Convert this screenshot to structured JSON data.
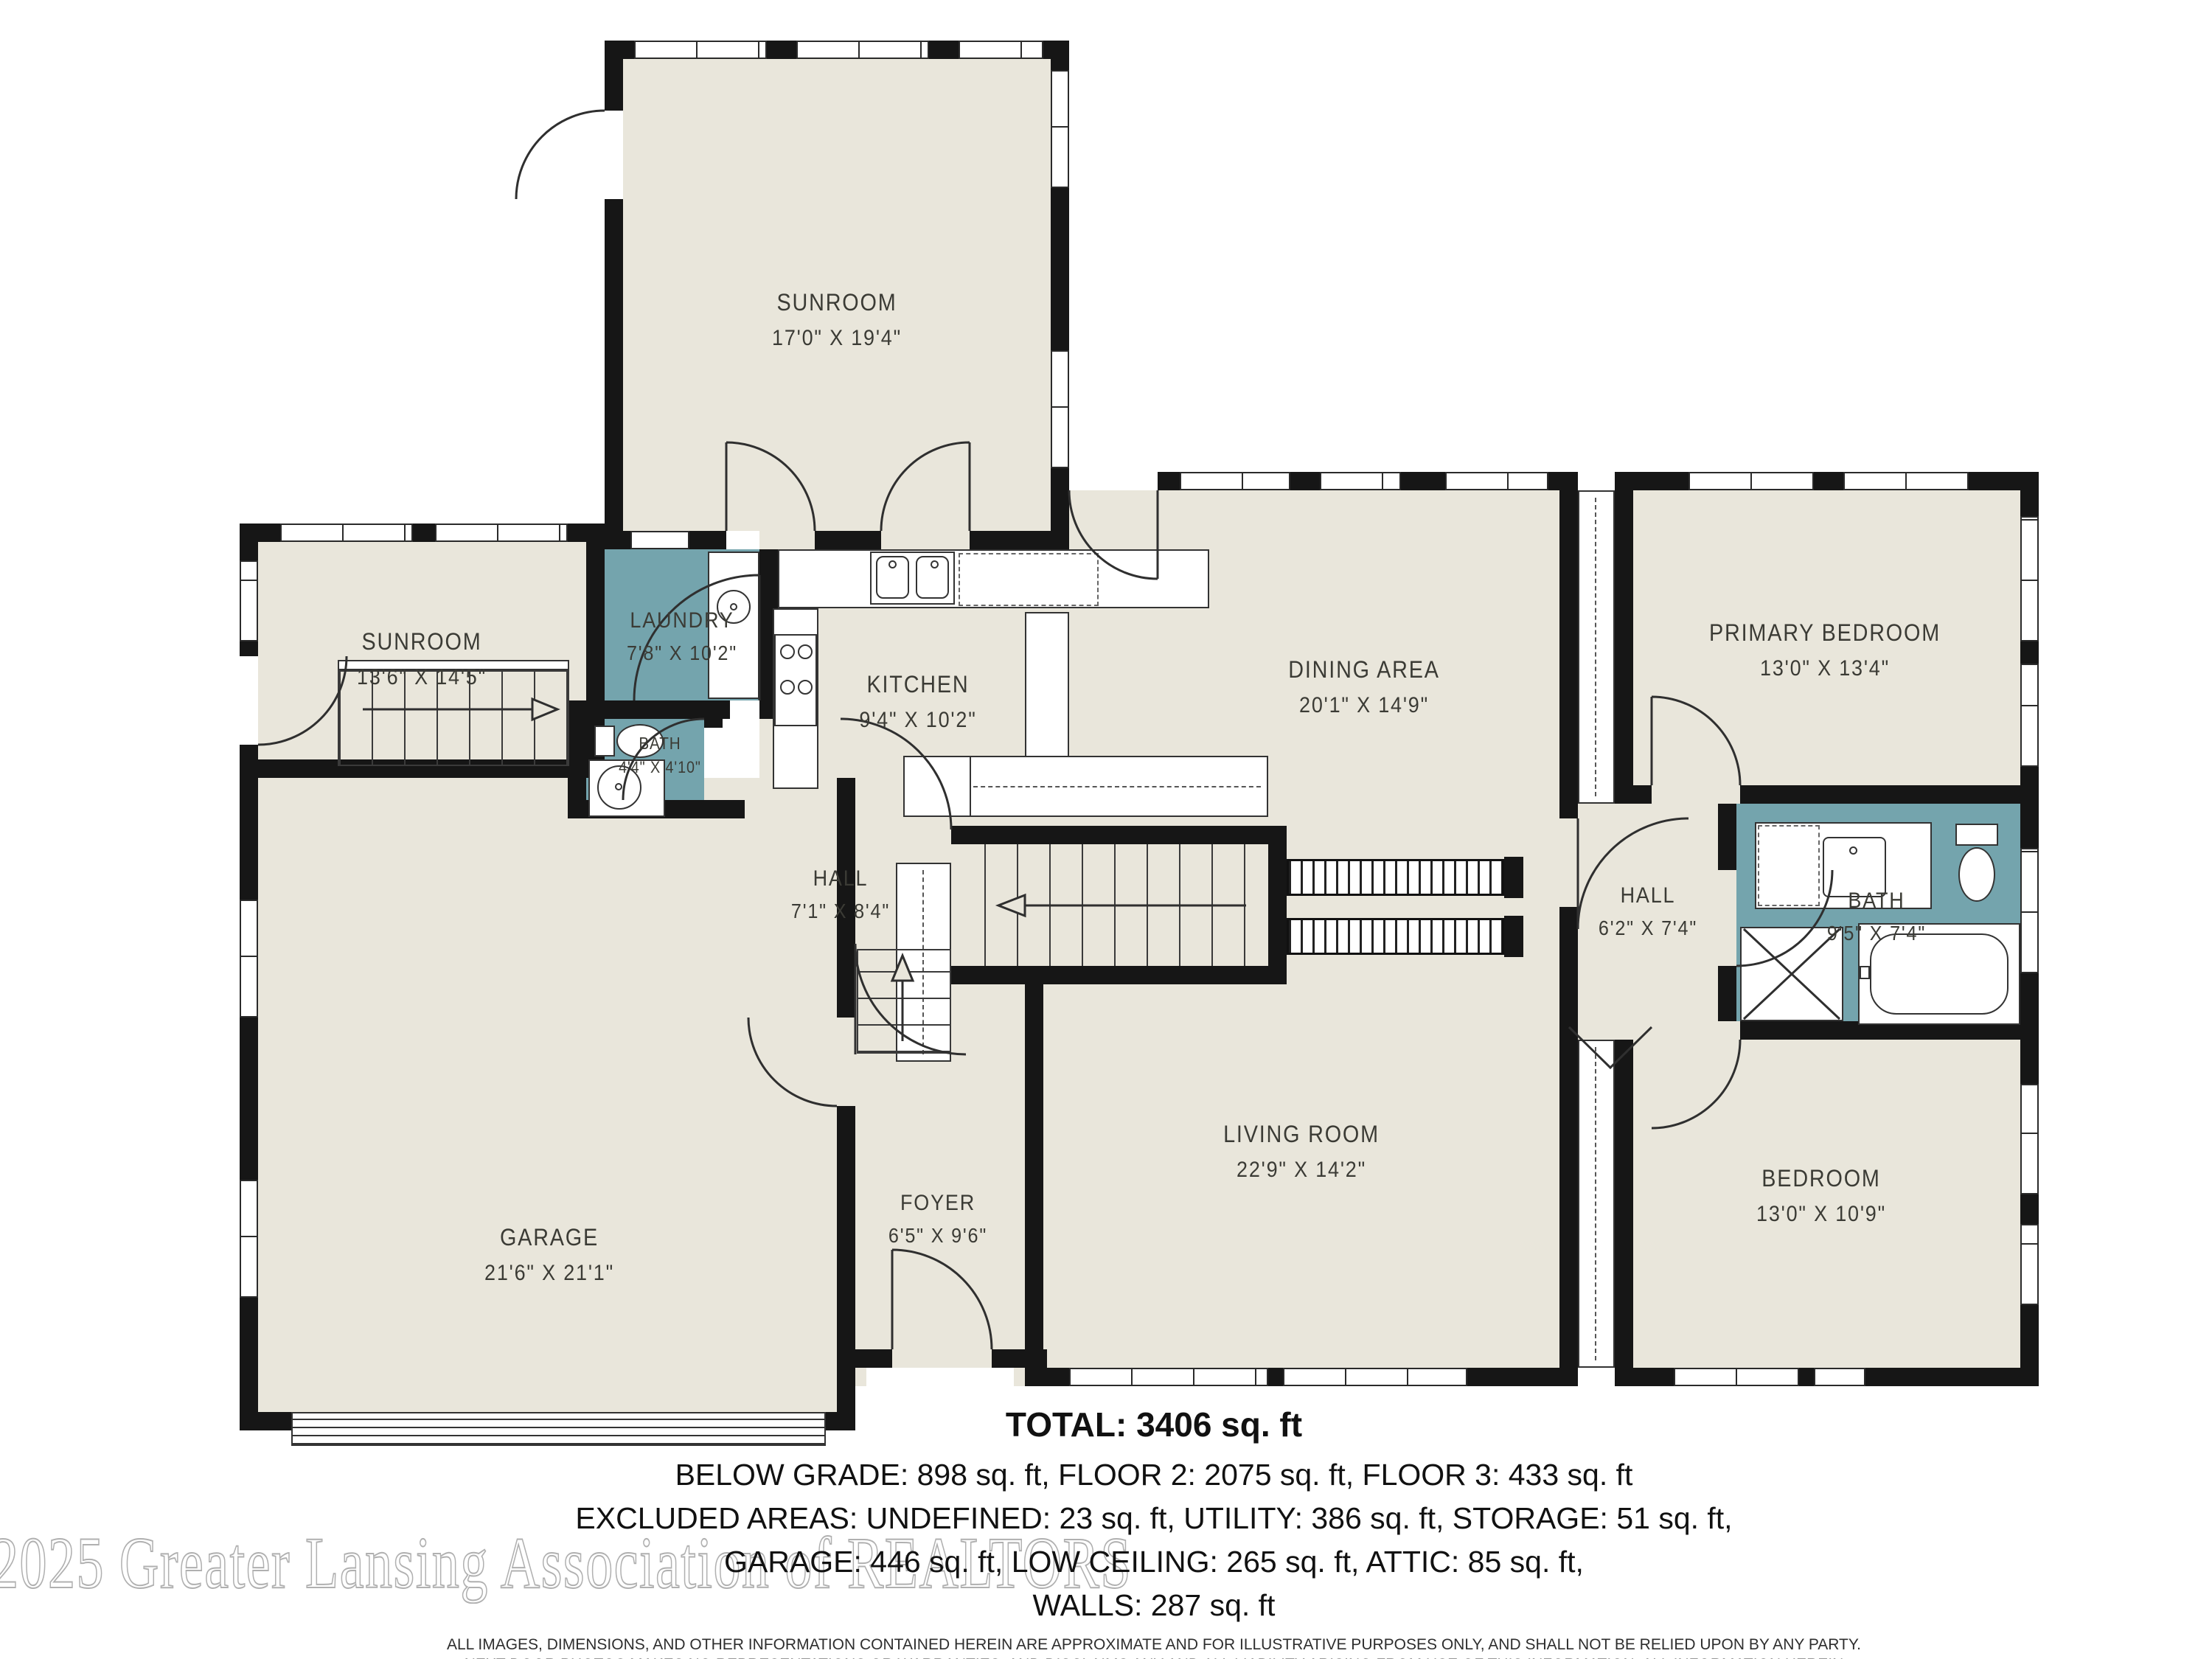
{
  "floorplan": {
    "rooms": [
      {
        "id": "sunroom_top",
        "name": "SUNROOM",
        "dims": "17'0\" X 19'4\""
      },
      {
        "id": "sunroom_left",
        "name": "SUNROOM",
        "dims": "13'6\" X 14'5\""
      },
      {
        "id": "laundry",
        "name": "LAUNDRY",
        "dims": "7'8\" X 10'2\""
      },
      {
        "id": "bath_small",
        "name": "BATH",
        "dims": "4'4\" X 4'10\""
      },
      {
        "id": "kitchen",
        "name": "KITCHEN",
        "dims": "9'4\" X 10'2\""
      },
      {
        "id": "dining_area",
        "name": "DINING AREA",
        "dims": "20'1\" X 14'9\""
      },
      {
        "id": "primary_bedroom",
        "name": "PRIMARY BEDROOM",
        "dims": "13'0\" X 13'4\""
      },
      {
        "id": "hall_left",
        "name": "HALL",
        "dims": "7'1\" X 8'4\""
      },
      {
        "id": "hall_right",
        "name": "HALL",
        "dims": "6'2\" X 7'4\""
      },
      {
        "id": "bath_right",
        "name": "BATH",
        "dims": "9'5\" X 7'4\""
      },
      {
        "id": "garage",
        "name": "GARAGE",
        "dims": "21'6\" X 21'1\""
      },
      {
        "id": "foyer",
        "name": "FOYER",
        "dims": "6'5\" X 9'6\""
      },
      {
        "id": "living_room",
        "name": "LIVING ROOM",
        "dims": "22'9\" X 14'2\""
      },
      {
        "id": "bedroom",
        "name": "BEDROOM",
        "dims": "13'0\" X 10'9\""
      }
    ],
    "summary": {
      "total": "TOTAL: 3406 sq. ft",
      "line1": "BELOW GRADE: 898 sq. ft, FLOOR 2: 2075 sq. ft, FLOOR 3: 433 sq. ft",
      "line2": "EXCLUDED AREAS: UNDEFINED: 23 sq. ft, UTILITY: 386 sq. ft, STORAGE: 51 sq. ft,",
      "line3": "GARAGE: 446 sq. ft, LOW CEILING: 265 sq. ft, ATTIC: 85 sq. ft,",
      "line4": "WALLS: 287 sq. ft"
    },
    "disclaimer_lines": [
      "ALL IMAGES, DIMENSIONS, AND OTHER INFORMATION CONTAINED HEREIN ARE APPROXIMATE AND FOR ILLUSTRATIVE PURPOSES ONLY, AND SHALL NOT BE RELIED UPON BY ANY PARTY.",
      "NEXT DOOR PHOTOS MAKES NO REPRESENTATIONS OR WARRANTIES, AND DISCLAIMS ANY AND ALL LIABILITY ARISING FROM USE OF THIS INFORMATION. ALL INFORMATION HEREIN",
      "SHALL BE SUBJECT TO THE TERMS AND CONDITIONS FOUND AT NEXTDOORPHOTOS.COM/TC."
    ],
    "watermark": "2025 Greater Lansing Association of REALTORS",
    "fixtures": [
      "stairs",
      "garage-door",
      "kitchen-sink",
      "stove",
      "island-counter",
      "laundry-cabinets",
      "toilet",
      "pedestal-sink",
      "vanity-sink",
      "bathtub",
      "linen-closet",
      "railing",
      "closet"
    ],
    "colors": {
      "room_fill": "#e9e6db",
      "wet_room_fill": "#74a4ad",
      "wall": "#161616",
      "label_text": "#3b3b35",
      "watermark_outline": "#b0b0b0"
    }
  }
}
